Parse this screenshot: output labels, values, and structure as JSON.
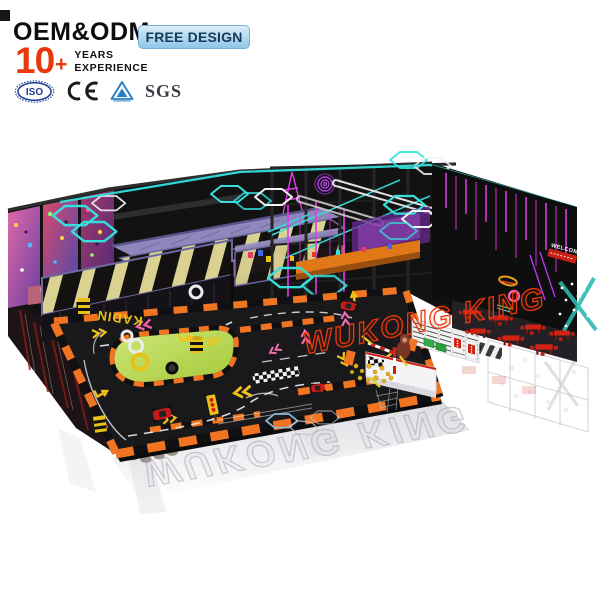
{
  "header": {
    "oem_odm": "OEM&ODM",
    "free_design": "FREE DESIGN",
    "years": {
      "number": "10",
      "plus": "+",
      "line1": "YEARS",
      "line2": "EXPERIENCE"
    },
    "certifications": {
      "iso": "ISO",
      "ce": "CE",
      "sgs": "SGS"
    }
  },
  "scene": {
    "watermark": "WUKONG KING",
    "watermark_reflection": "WUKONG KING",
    "welcome_sign": "WELCOME",
    "kart_floor_text": "KADIN",
    "colors": {
      "accent_red": "#e8380c",
      "free_design_bg": "#a9d3ec",
      "neon_cyan": "#35e0dc",
      "neon_magenta": "#e83ae8",
      "barrier_orange": "#f07422",
      "trampoline_yellow": "#ded593",
      "island_green": "#b5d94a",
      "cafe_red": "#d42015",
      "canopy_purple": "#8d87bb"
    }
  }
}
